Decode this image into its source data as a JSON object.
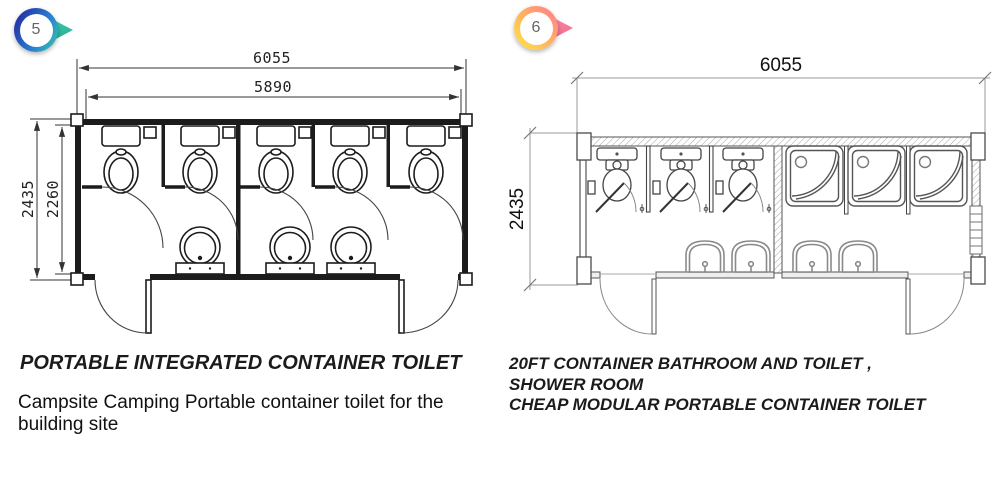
{
  "left": {
    "badge": "5",
    "title": "PORTABLE INTEGRATED CONTAINER TOILET",
    "description": "Campsite Camping Portable container toilet for the building site",
    "dims": {
      "width_outer": "6055",
      "width_inner": "5890",
      "height_outer": "2435",
      "height_inner": "2260"
    },
    "fixtures": {
      "toilet_stalls": 5,
      "wash_basins": 3,
      "entry_doors": 2
    }
  },
  "right": {
    "badge": "6",
    "title_line1": "20FT CONTAINER BATHROOM AND TOILET ,",
    "title_line2": "SHOWER ROOM",
    "title_line3": "CHEAP MODULAR PORTABLE CONTAINER TOILET",
    "dims": {
      "width_outer": "6055",
      "height_outer": "2435"
    },
    "fixtures": {
      "toilet_stalls": 3,
      "showers": 3,
      "wash_basins": 4,
      "entry_doors": 2
    }
  },
  "colors": {
    "badge5_ring": "#2430a6",
    "badge5_arrow": "#35c2b0",
    "badge6_ring": "#ff7f8d",
    "badge6_arrow": "#f2688e",
    "linework": "#1c1c1c",
    "linework_right_plan": "#555555"
  }
}
